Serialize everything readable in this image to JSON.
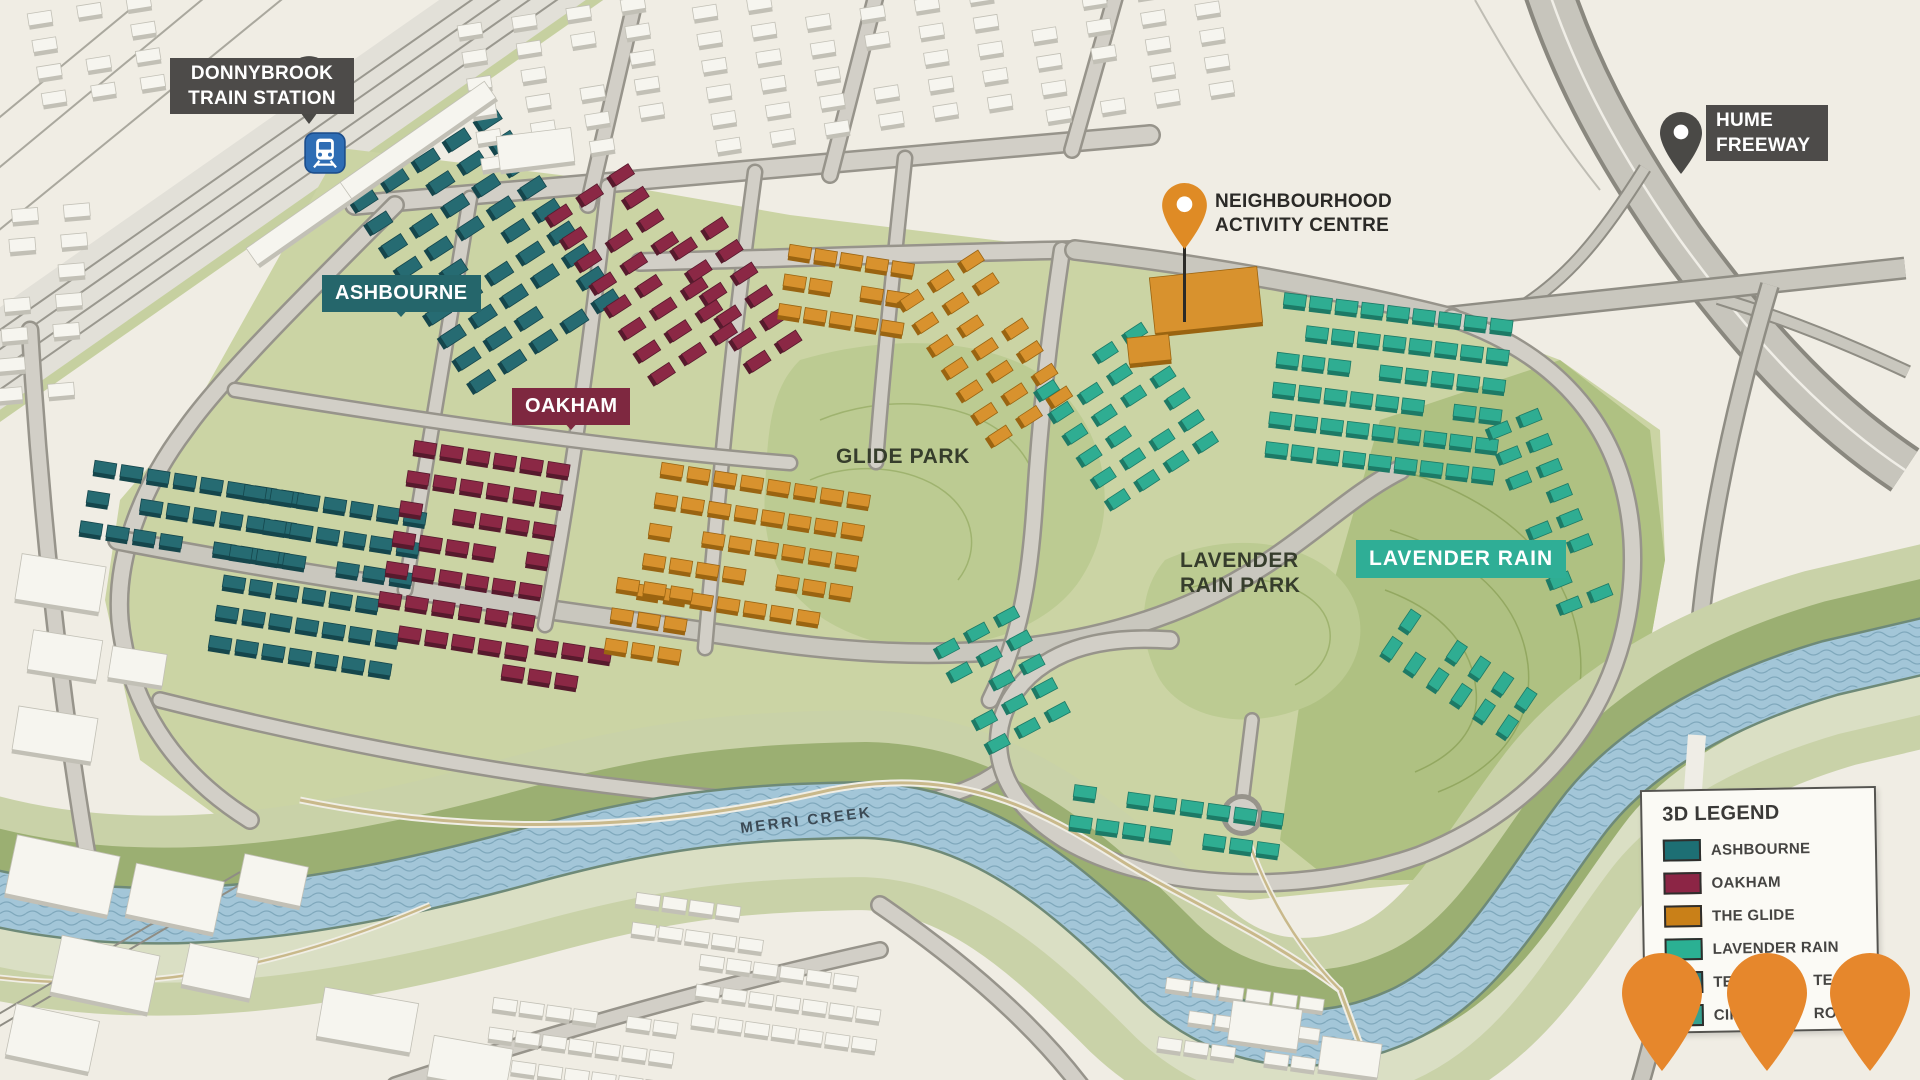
{
  "map": {
    "station": {
      "line1": "DONNYBROOK",
      "line2": "TRAIN STATION"
    },
    "freeway": {
      "line1": "HUME",
      "line2": "FREEWAY"
    },
    "activity_centre": {
      "line1": "NEIGHBOURHOOD",
      "line2": "ACTIVITY CENTRE"
    },
    "neighbourhoods": {
      "ashbourne": "ASHBOURNE",
      "oakham": "OAKHAM",
      "lavender_rain": "LAVENDER RAIN"
    },
    "parks": {
      "glide": "GLIDE PARK",
      "lavender_line1": "LAVENDER",
      "lavender_line2": "RAIN PARK"
    },
    "creek": "MERRI CREEK",
    "legend": {
      "title": "3D LEGEND",
      "rows": [
        {
          "label": "ASHBOURNE",
          "color": "#1D6F74"
        },
        {
          "label": "OAKHAM",
          "color": "#8C2545"
        },
        {
          "label": "THE GLIDE",
          "color": "#C98018"
        },
        {
          "label": "LAVENDER RAIN",
          "color": "#2BB093"
        },
        {
          "label_left": "TER",
          "label_right": "TE",
          "color": "#2E8080"
        },
        {
          "label_left": "CIR",
          "label_right": "ROU",
          "color": "#36A18F"
        }
      ]
    },
    "icons": {
      "station_pin": "train-pin",
      "station_badge": "train-badge",
      "freeway_pin": "location-pin",
      "activity_pin": "location-pin",
      "corner_pins": "location-pin"
    },
    "colors": {
      "ashbourne": "#266B72",
      "ashbourne_side": "#15464C",
      "oakham": "#8B2845",
      "oakham_side": "#571A2D",
      "glide": "#D8922E",
      "glide_side": "#9A6411",
      "lavender": "#2FAD92",
      "lavender_side": "#1D7A66",
      "existing": "#F6F5EF",
      "existing_side": "#C2C0B6",
      "pin_orange": "#E6872C",
      "label_bg": "#4D4B49",
      "tag_ashbourne": "#25666B",
      "tag_oakham": "#7E2840",
      "tag_lavender": "#2FAE96",
      "train_blue": "#2E6DB4"
    }
  }
}
